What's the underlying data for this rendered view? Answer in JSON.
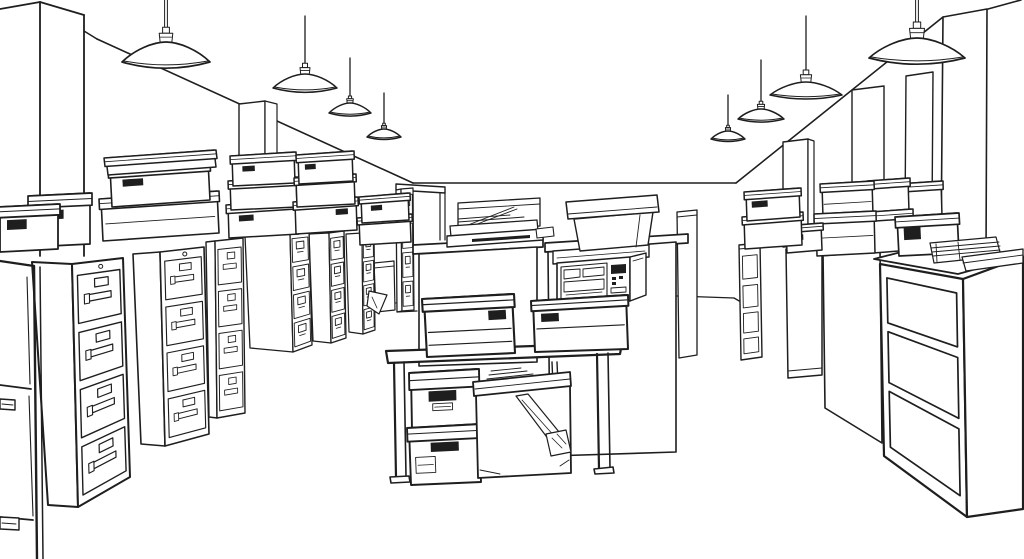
{
  "meta": {
    "title": "Black-and-white line-art illustration of an office storage room with filing cabinets, archive boxes, pendant lamps, a counter with a microwave, a work table and a desk",
    "medium": "ink line sketch",
    "perspective": "one-point aisle view"
  },
  "colors": {
    "ink": "#1e1e1e",
    "background": "#ffffff",
    "fill": "#ffffff"
  },
  "scene": {
    "ceiling": {
      "pendant_lamps": 8
    },
    "back_wall": {
      "doorways": 1
    },
    "left_side": {
      "filing_cabinets": 8,
      "drawers_per_cabinet": 4,
      "archive_boxes_on_cabinets": 13
    },
    "center": {
      "counter_units": 2,
      "microwave": 1,
      "plastic_tote": 1,
      "clear_storage_bin": 1,
      "printer": 1,
      "work_table": 1,
      "boxes_on_table": 2,
      "boxes_under_table": 3
    },
    "right_side": {
      "wall_pilasters": 5,
      "narrow_shelf_unit": 1,
      "tall_cabinets": 2,
      "office_desk": 1,
      "archive_boxes": 9,
      "paper_stacks": 1,
      "document_trays": 1
    }
  }
}
